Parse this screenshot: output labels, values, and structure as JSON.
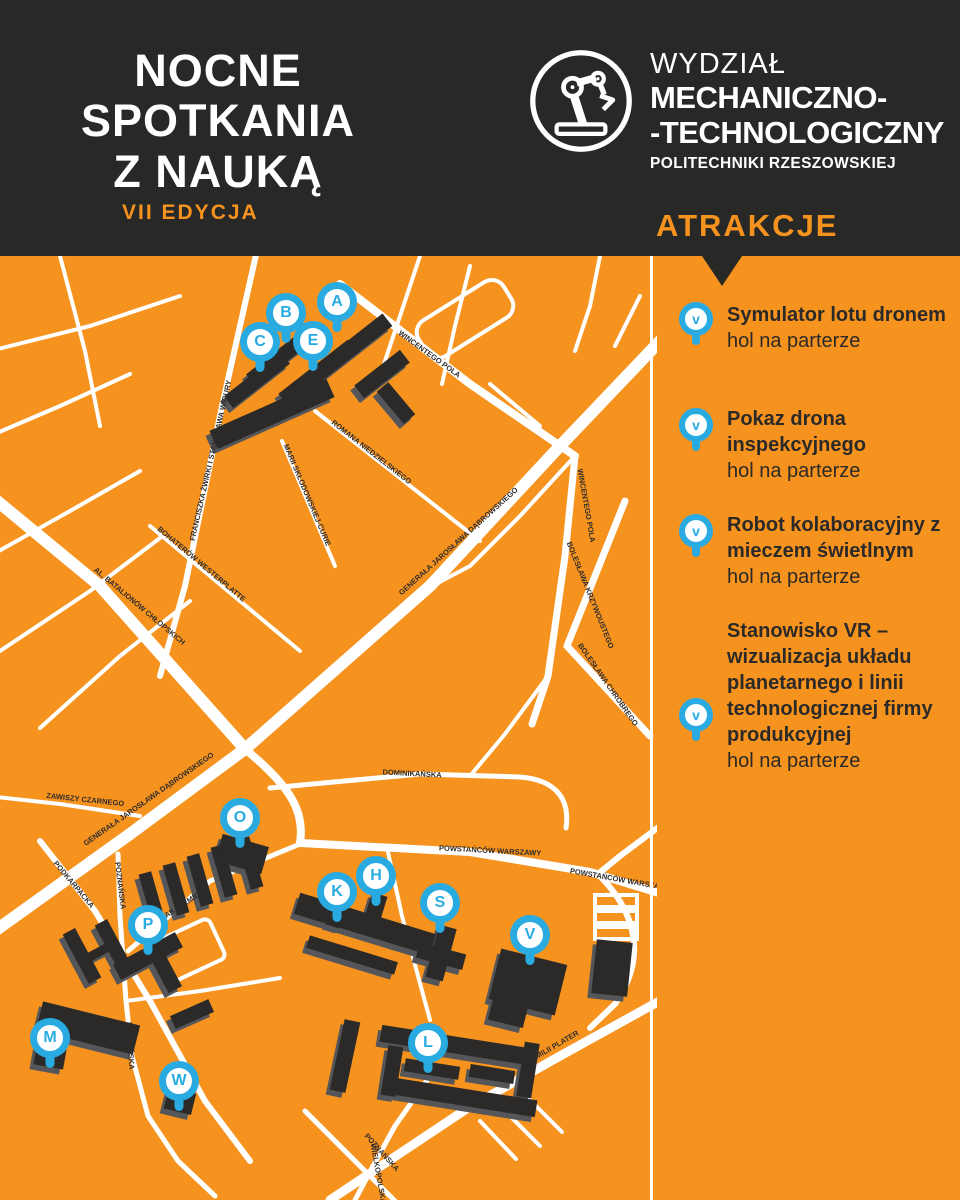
{
  "colors": {
    "orange": "#F6921E",
    "dark": "#282826",
    "blue": "#29ABE2",
    "white": "#FFFFFF",
    "building": "#2B2A28"
  },
  "header": {
    "event_logo": {
      "line1": "NOCNE",
      "line2": "SPOTKANIA",
      "line3": "Z NAUKĄ",
      "edition": "VII EDYCJA"
    },
    "faculty_logo": {
      "icon": "robot-arm-icon",
      "line1": "WYDZIAŁ",
      "line2": "MECHANICZNO-",
      "line3": "-TECHNOLOGICZNY",
      "line4": "POLITECHNIKI RZESZOWSKIEJ"
    }
  },
  "sidebar": {
    "title": "ATRAKCJE",
    "marker_icon": "v-location-pin-icon",
    "items": [
      {
        "marker": "v",
        "title": "Symulator lotu dronem",
        "location": "hol na parterze"
      },
      {
        "marker": "v",
        "title": "Pokaz drona inspekcyjnego",
        "location": "hol na parterze"
      },
      {
        "marker": "v",
        "title": "Robot kolaboracyjny z mieczem świetlnym",
        "location": "hol na parterze"
      },
      {
        "marker": "v",
        "title": "Stanowisko VR – wizualizacja układu planetarnego i linii technologicznej firmy produkcyjnej",
        "location": "hol na parterze"
      }
    ]
  },
  "map": {
    "markers": [
      {
        "letter": "A",
        "x": 337,
        "y": 46
      },
      {
        "letter": "B",
        "x": 286,
        "y": 57
      },
      {
        "letter": "C",
        "x": 260,
        "y": 86
      },
      {
        "letter": "E",
        "x": 313,
        "y": 85
      },
      {
        "letter": "O",
        "x": 240,
        "y": 562
      },
      {
        "letter": "K",
        "x": 337,
        "y": 636
      },
      {
        "letter": "H",
        "x": 376,
        "y": 620
      },
      {
        "letter": "S",
        "x": 440,
        "y": 647
      },
      {
        "letter": "V",
        "x": 530,
        "y": 679
      },
      {
        "letter": "P",
        "x": 148,
        "y": 669
      },
      {
        "letter": "M",
        "x": 50,
        "y": 782
      },
      {
        "letter": "W",
        "x": 179,
        "y": 825
      },
      {
        "letter": "L",
        "x": 428,
        "y": 787
      }
    ],
    "street_labels": [
      {
        "name": "WINCENTEGO POLA",
        "x": 428,
        "y": 100,
        "rot": 36
      },
      {
        "name": "WINCENTEGO POLA",
        "x": 584,
        "y": 250,
        "rot": 80
      },
      {
        "name": "ROMANA NIEDZIELSKIEGO",
        "x": 370,
        "y": 198,
        "rot": 38
      },
      {
        "name": "MARII SKŁODOWSKIEJ-CURIE",
        "x": 305,
        "y": 240,
        "rot": 67
      },
      {
        "name": "FRANCISZKA ŻWIRKI I STANISŁAWA WIGURY",
        "x": 213,
        "y": 205,
        "rot": -77
      },
      {
        "name": "BOHATERÓW WESTERPLATTE",
        "x": 200,
        "y": 310,
        "rot": 40
      },
      {
        "name": "AL. BATALIONÓW CHŁOPSKICH",
        "x": 138,
        "y": 352,
        "rot": 40
      },
      {
        "name": "GENERAŁA JAROSŁAWA DĄBROWSKIEGO",
        "x": 460,
        "y": 287,
        "rot": -42
      },
      {
        "name": "BOLESŁAWA KRZYWOUSTEGO",
        "x": 588,
        "y": 340,
        "rot": 68
      },
      {
        "name": "BOLESŁAWA CHROBREGO",
        "x": 606,
        "y": 430,
        "rot": 55
      },
      {
        "name": "GENERAŁA JAROSŁAWA DĄBROWSKIEGO",
        "x": 150,
        "y": 545,
        "rot": -35
      },
      {
        "name": "ZAWISZY CZARNEGO",
        "x": 85,
        "y": 546,
        "rot": 6
      },
      {
        "name": "PODKARPACKA",
        "x": 72,
        "y": 630,
        "rot": 50
      },
      {
        "name": "POZNAŃSKA",
        "x": 118,
        "y": 630,
        "rot": 83
      },
      {
        "name": "POZNAŃSKA",
        "x": 128,
        "y": 790,
        "rot": 87
      },
      {
        "name": "POZNAŃSKA",
        "x": 380,
        "y": 898,
        "rot": 48
      },
      {
        "name": "AKADEMICKA",
        "x": 188,
        "y": 648,
        "rot": -33
      },
      {
        "name": "DOMINIKAŃSKA",
        "x": 412,
        "y": 520,
        "rot": 3
      },
      {
        "name": "POWSTAŃCÓW WARSZAWY",
        "x": 490,
        "y": 597,
        "rot": 3
      },
      {
        "name": "POWSTAŃCÓW WARSZAWY",
        "x": 620,
        "y": 626,
        "rot": 10
      },
      {
        "name": "EMILII PLATER",
        "x": 556,
        "y": 792,
        "rot": -30
      },
      {
        "name": "WIELKOPOLSKA",
        "x": 376,
        "y": 918,
        "rot": 80
      }
    ]
  }
}
